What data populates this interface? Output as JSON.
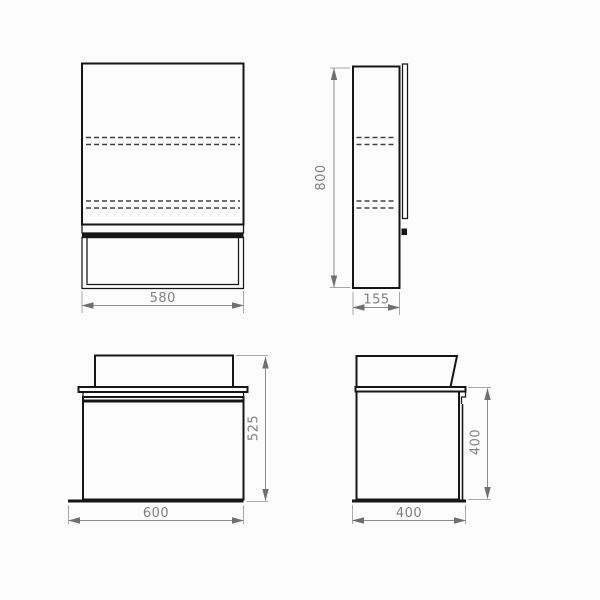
{
  "page": {
    "background": "#fcfcfc"
  },
  "colors": {
    "object_line": "#161616",
    "dashed_line": "#404040",
    "dimension_line": "#8c8c8c",
    "extension_line": "#a8a8a8",
    "arrow": "#6f6f6f",
    "dimension_text": "#808080"
  },
  "dimensions": {
    "mirror_front_width": "580",
    "mirror_side_height": "800",
    "mirror_side_depth": "155",
    "vanity_front_width": "600",
    "vanity_front_height": "525",
    "vanity_side_height": "400",
    "vanity_side_depth": "400"
  }
}
